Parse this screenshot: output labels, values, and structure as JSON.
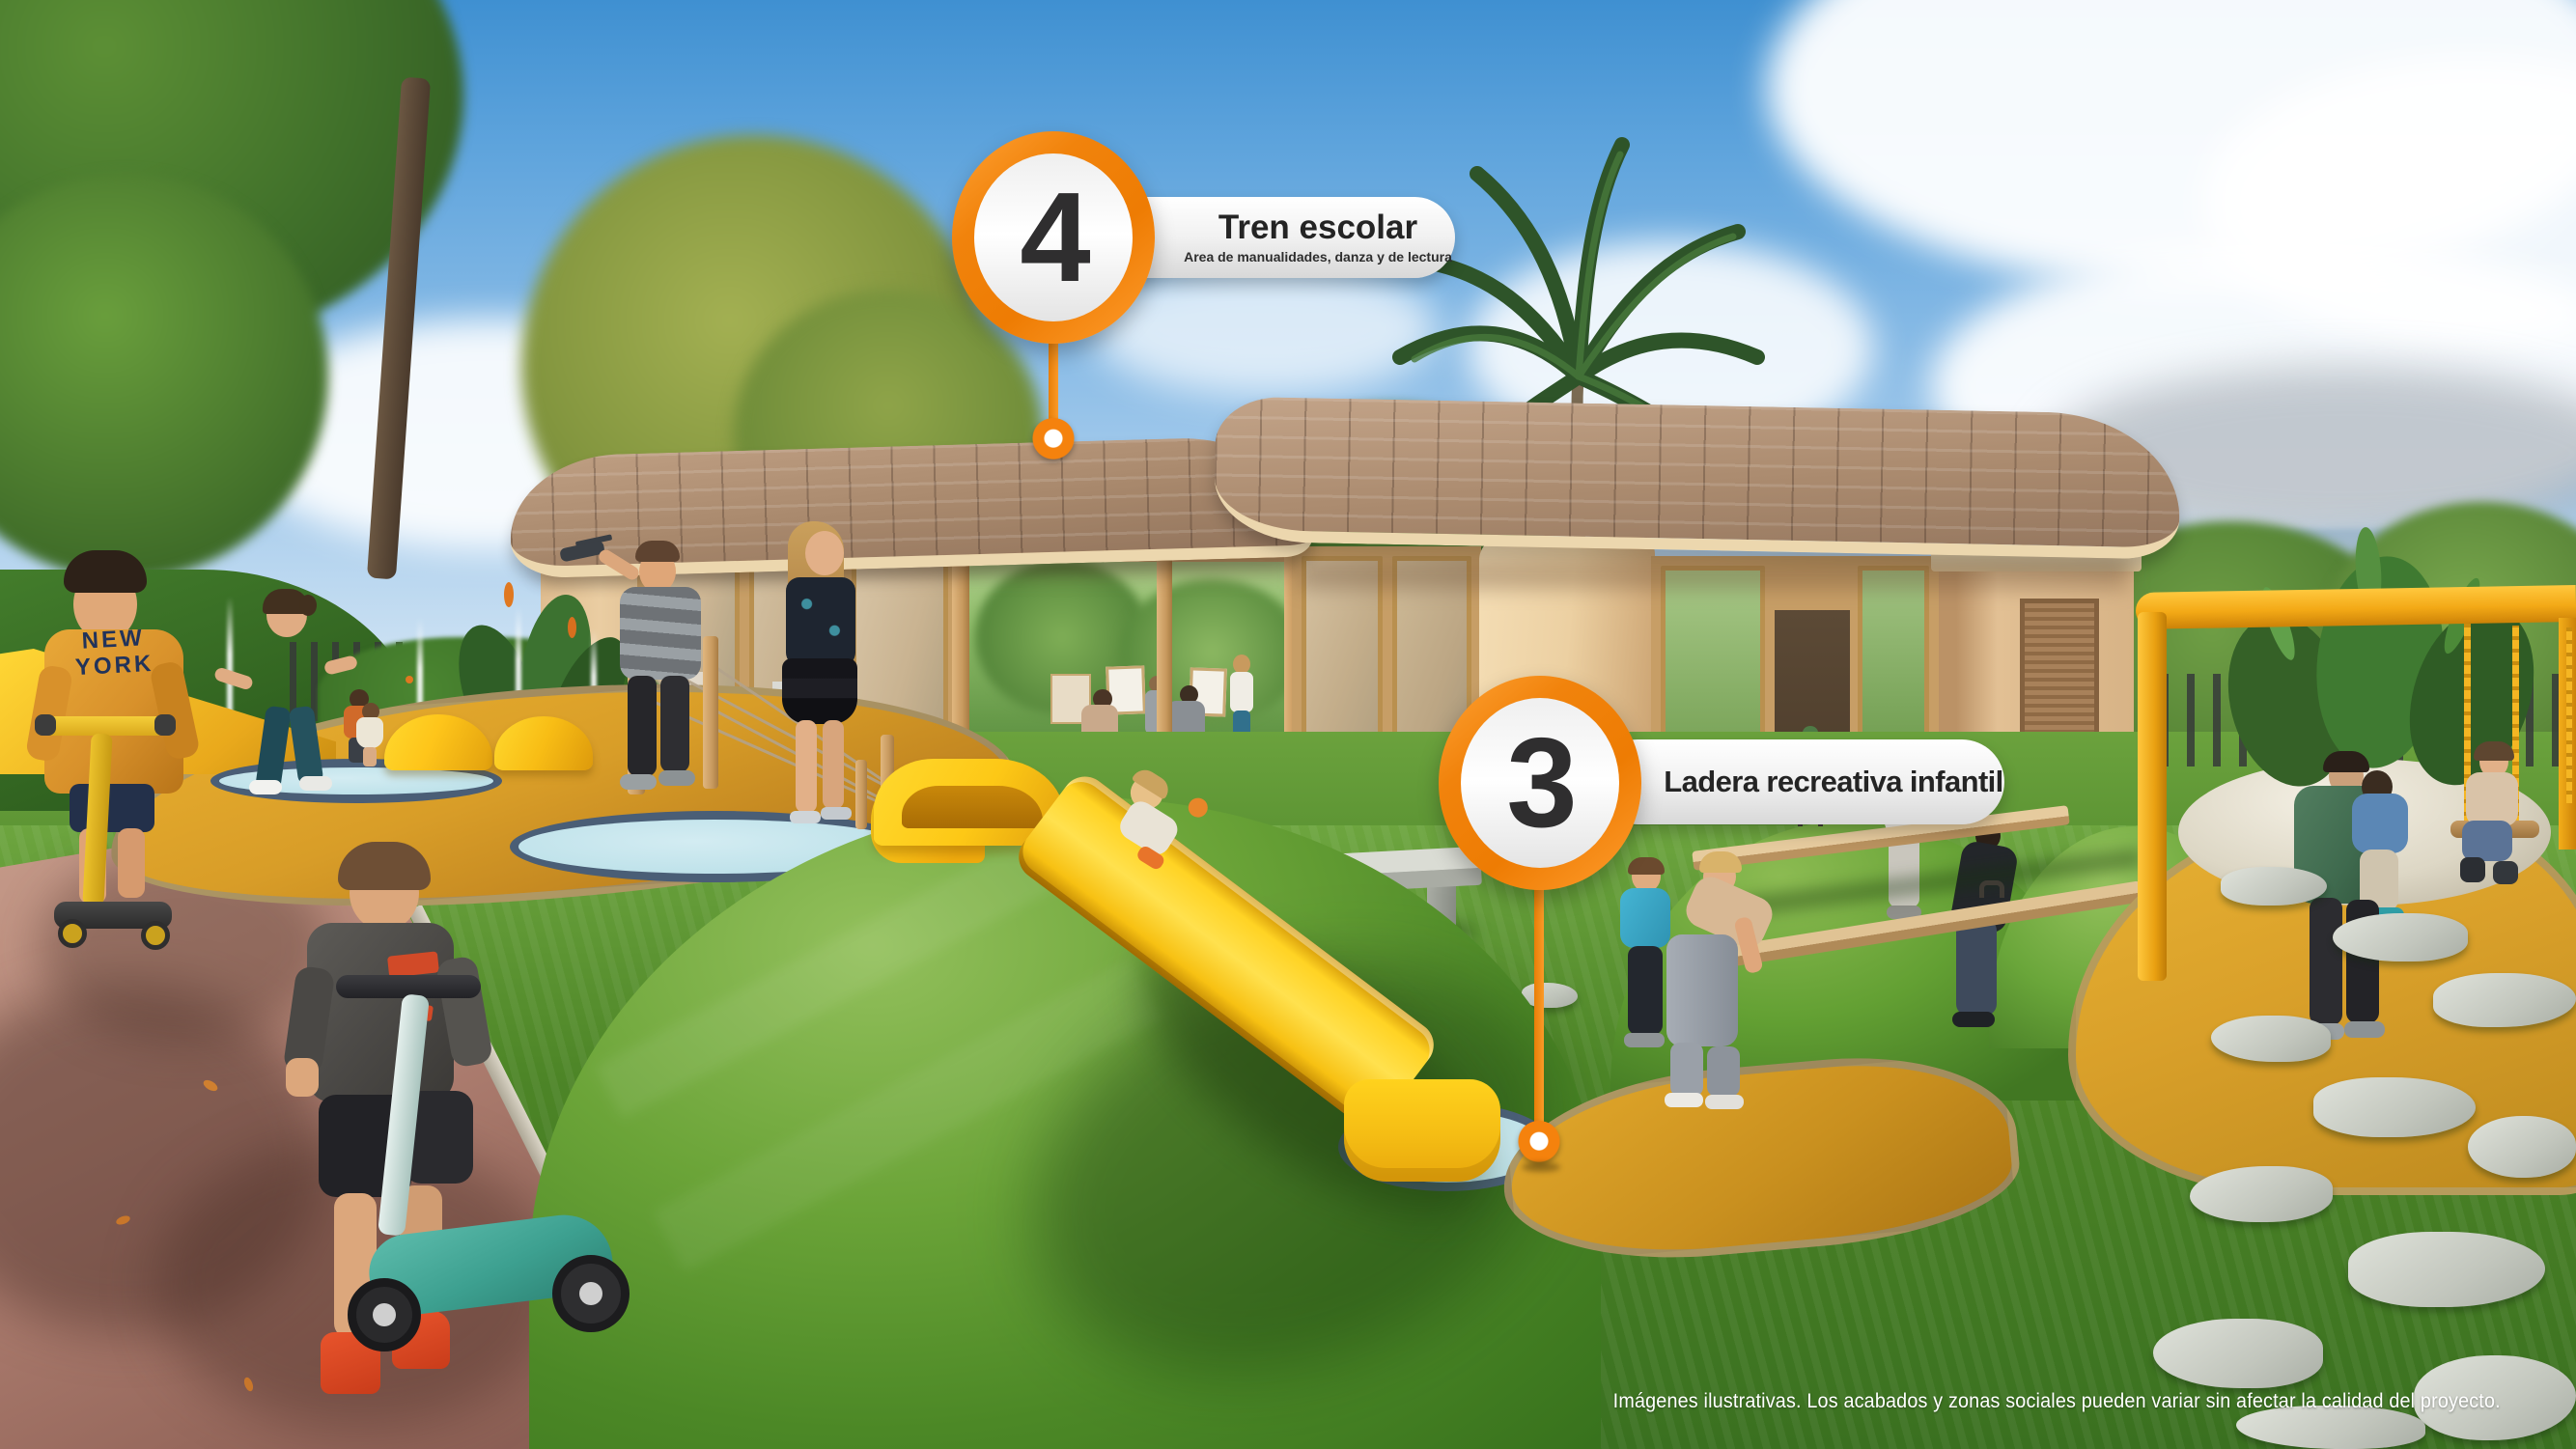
{
  "callouts": [
    {
      "number": "4",
      "title": "Tren escolar",
      "subtitle": "Area de manualidades, danza y de lectura"
    },
    {
      "number": "3",
      "title": "Ladera recreativa infantil",
      "subtitle": ""
    }
  ],
  "footer": {
    "disclaimer": "Imágenes ilustrativas. Los acabados y zonas sociales pueden variar sin afectar la calidad del proyecto."
  },
  "scene": {
    "shirt_text": "NEW\nYORK"
  },
  "colors": {
    "accent_orange": "#F5820D",
    "badge_number": "#2F2E2F",
    "label_text": "#242424",
    "play_surface_yellow": "#D89D28",
    "slide_yellow": "#FFC812",
    "pad_teal": "#C3E3EA",
    "grass_green": "#4D8527",
    "sky_blue": "#4E9AD6",
    "roof_brown": "#A8886C",
    "wall_cream": "#EACDA2",
    "path_mauve": "#B08072",
    "disclaimer_text": "#FFFFFF"
  }
}
